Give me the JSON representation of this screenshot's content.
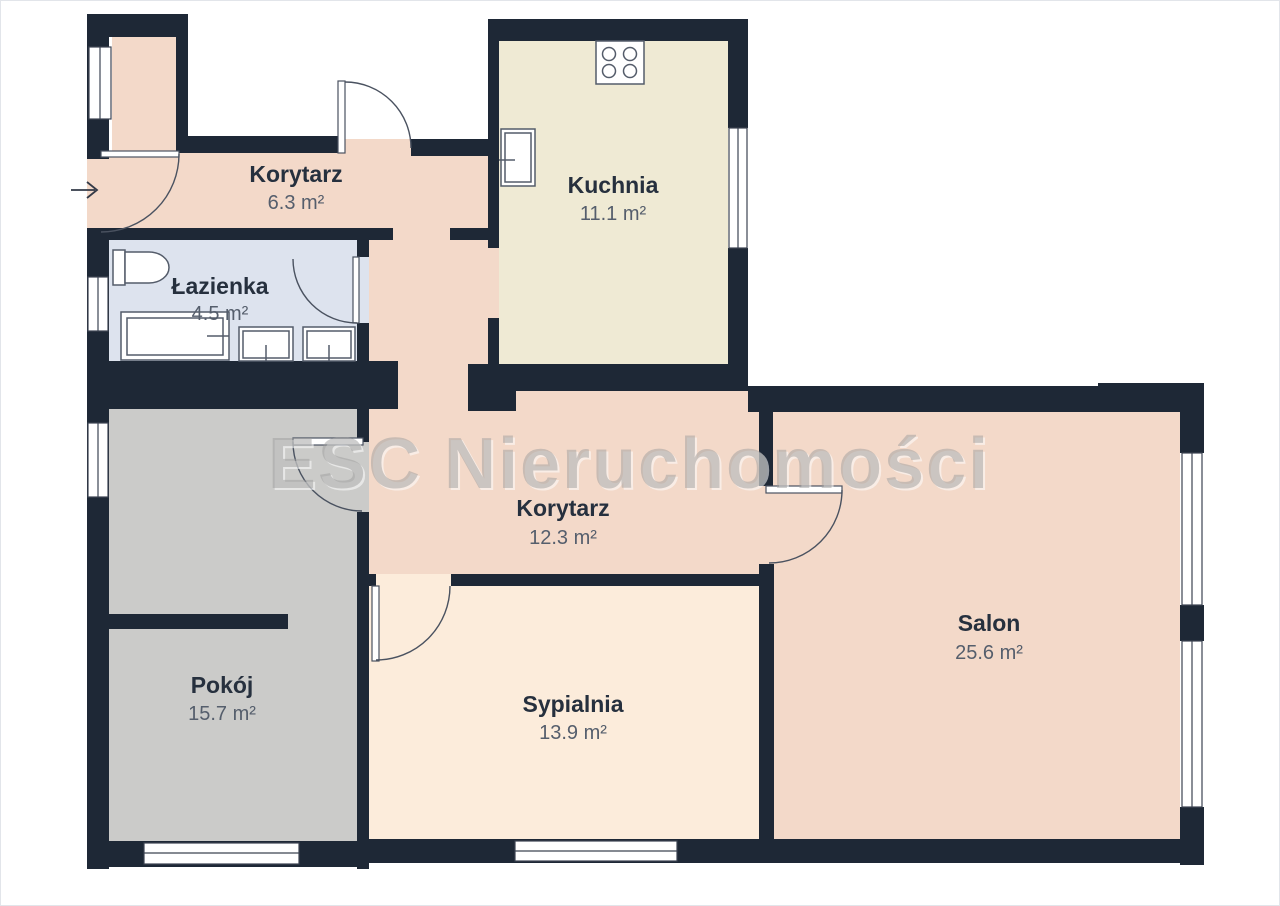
{
  "title": "Floor plan",
  "watermark": "ESC Nieruchomości",
  "rooms": [
    {
      "name": "Korytarz",
      "area": "6.3 m²"
    },
    {
      "name": "Kuchnia",
      "area": "11.1 m²"
    },
    {
      "name": "Łazienka",
      "area": "4.5 m²"
    },
    {
      "name": "Korytarz",
      "area": "12.3 m²"
    },
    {
      "name": "Pokój",
      "area": "15.7 m²"
    },
    {
      "name": "Sypialnia",
      "area": "13.9 m²"
    },
    {
      "name": "Salon",
      "area": "25.6 m²"
    }
  ],
  "icons": {
    "entrance_arrow": "right-arrow",
    "stove": "cooktop-4-burners",
    "kitchen_sink": "sink",
    "toilet": "toilet",
    "bathtub": "bathtub",
    "washer": "washing-machine",
    "bathroom_sink": "sink"
  },
  "colors": {
    "wall": "#1e2836",
    "corridor_floor": "#f3d9c9",
    "kitchen_floor": "#efead4",
    "bathroom_floor": "#dde3ee",
    "room_floor": "#cbcbc9",
    "bedroom_floor": "#fcecdb",
    "living_floor": "#f3d9c9",
    "label_text": "#26303e",
    "area_text": "#555e6c",
    "watermark_text": "#9e9e9e",
    "background": "#ffffff"
  }
}
